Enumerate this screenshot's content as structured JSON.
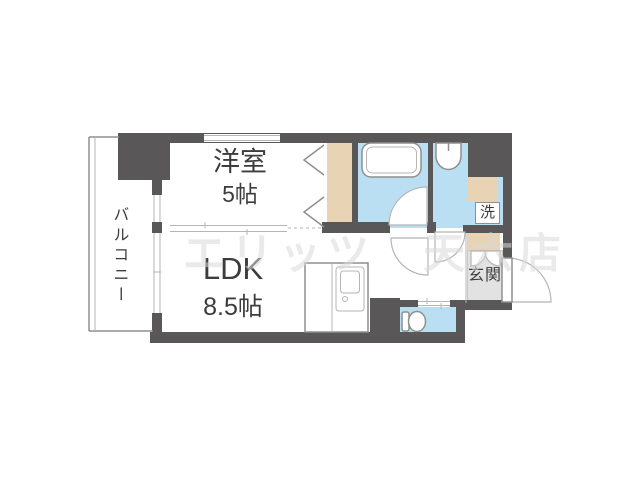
{
  "colors": {
    "wall": "#595757",
    "water": "#badff2",
    "wood": "#e8d4b4",
    "genkan": "#e2e2e2",
    "line": "#8f8f8f",
    "soft": "#b5b5b5",
    "text": "#3c3c3c",
    "wm": "#d9d9d9"
  },
  "plan": {
    "type": "apartment-floor-plan",
    "watermark": "エリッツ　天六店",
    "rooms": {
      "western": {
        "label": "洋室",
        "size": "5帖"
      },
      "ldk": {
        "label": "LDK",
        "size": "8.5帖"
      },
      "balcony": {
        "label": "バルコニー"
      },
      "entrance": {
        "label": "玄関"
      },
      "laundry": {
        "label": "洗"
      }
    }
  }
}
